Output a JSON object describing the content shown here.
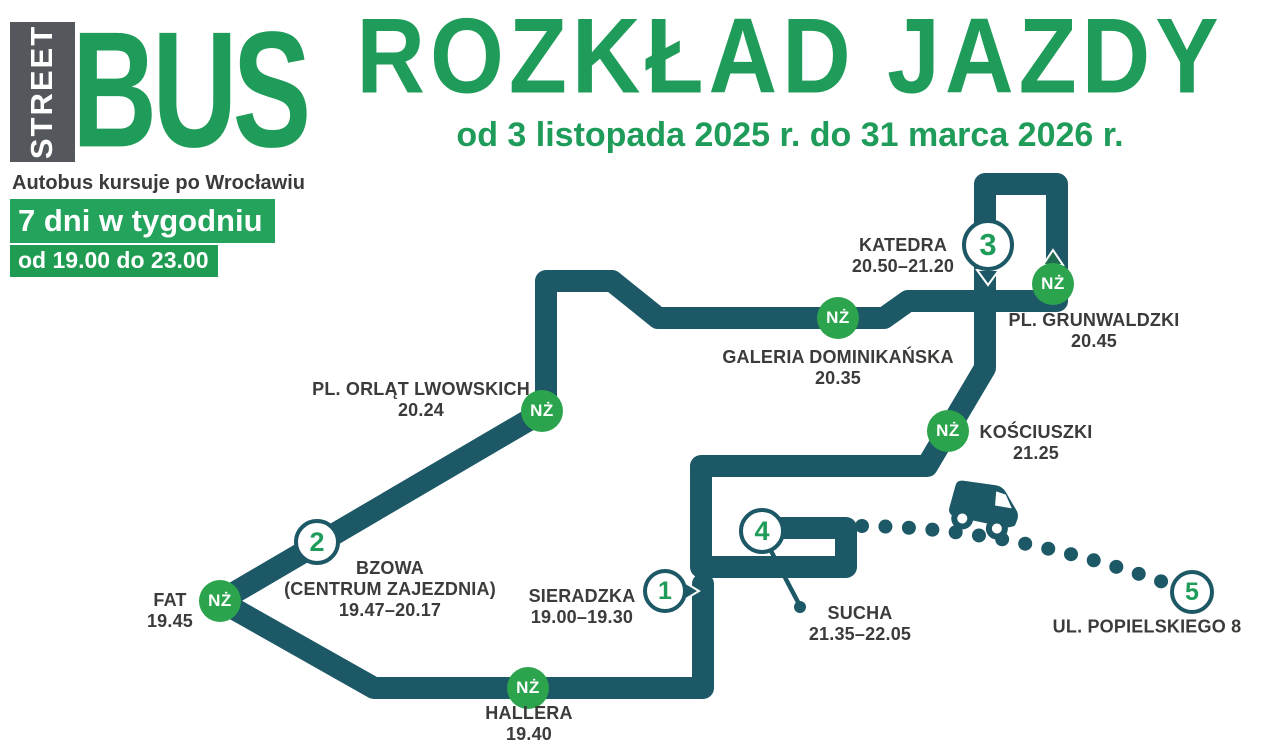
{
  "header": {
    "logo_street": "STREET",
    "logo_bus": "BUS",
    "title": "ROZKŁAD JAZDY",
    "subtitle": "od 3 listopada 2025 r. do 31 marca 2026 r.",
    "tagline": "Autobus kursuje po Wrocławiu",
    "schedule_days": "7 dni w tygodniu",
    "schedule_hours": "od 19.00 do 23.00"
  },
  "map": {
    "request_stop_badge": "NŻ",
    "numbered_stops": [
      {
        "number": "1",
        "name": "SIERADZKA",
        "time": "19.00–19.30"
      },
      {
        "number": "2",
        "name": "BZOWA",
        "name_line2": "(CENTRUM ZAJEZDNIA)",
        "time": "19.47–20.17"
      },
      {
        "number": "3",
        "name": "KATEDRA",
        "time": "20.50–21.20"
      },
      {
        "number": "4",
        "name": "SUCHA",
        "time": "21.35–22.05"
      },
      {
        "number": "5",
        "name": "UL. POPIELSKIEGO 8"
      }
    ],
    "request_stops": [
      {
        "name": "PL. ORLĄT LWOWSKICH",
        "time": "20.24"
      },
      {
        "name": "GALERIA DOMINIKAŃSKA",
        "time": "20.35"
      },
      {
        "name": "PL. GRUNWALDZKI",
        "time": "20.45"
      },
      {
        "name": "KOŚCIUSZKI",
        "time": "21.25"
      },
      {
        "name": "FAT",
        "time": "19.45"
      },
      {
        "name": "HALLERA",
        "time": "19.40"
      }
    ]
  },
  "colors": {
    "route_teal": "#1C5866",
    "badge_green": "#2BA44D",
    "brand_green": "#1F9C59",
    "logo_box_gray": "#54585D",
    "label_dark": "#3B3B3A"
  }
}
